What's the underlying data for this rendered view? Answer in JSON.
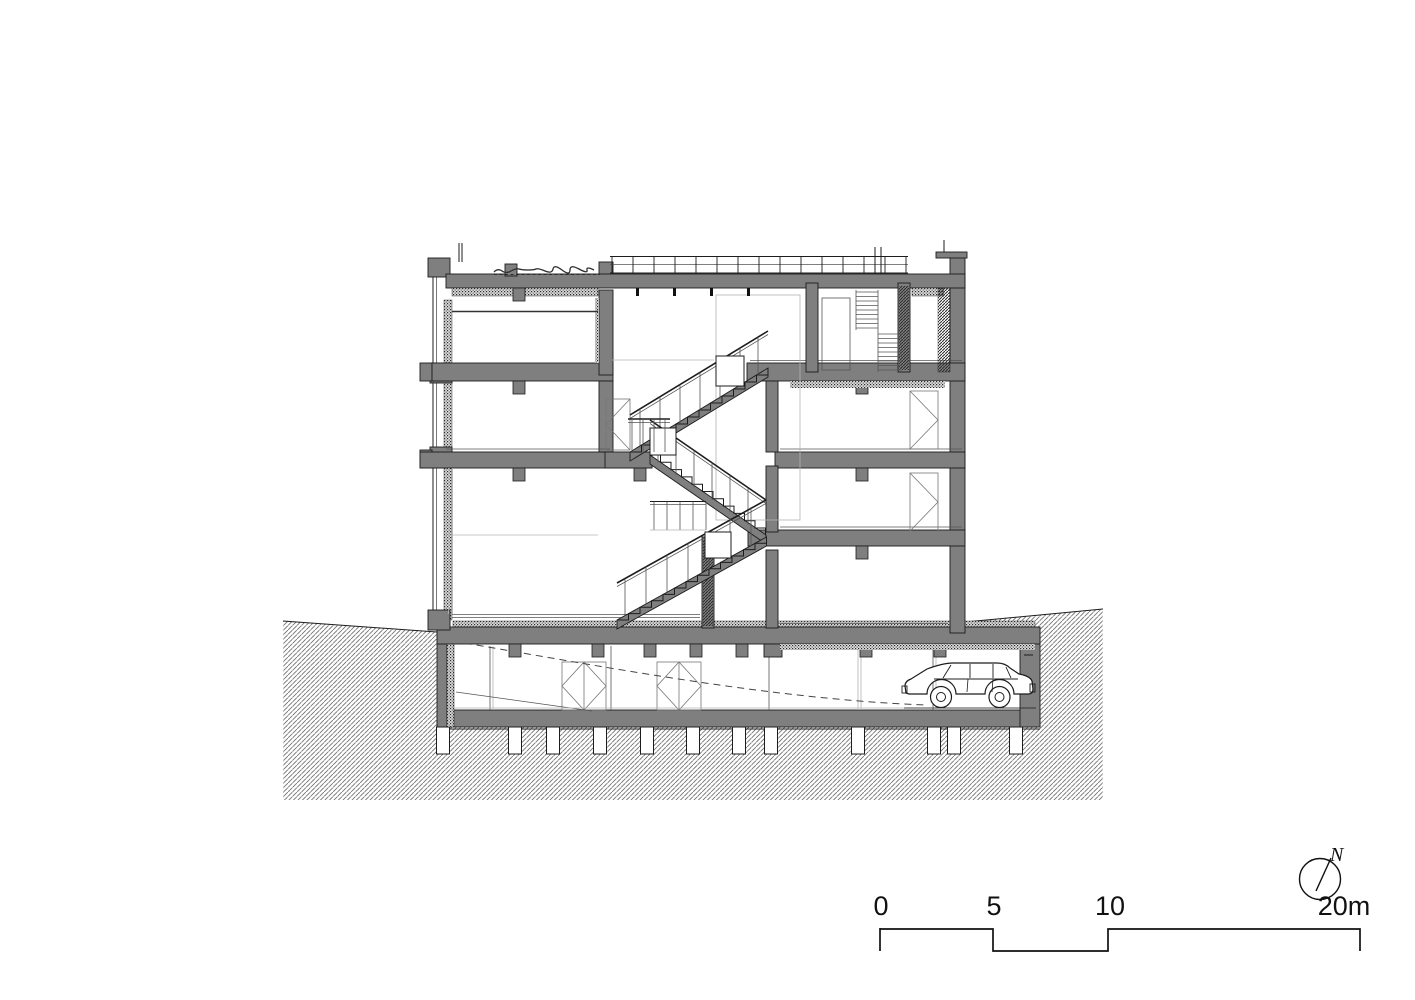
{
  "annotations": {
    "scale_bar": {
      "tick_labels": [
        "0",
        "5",
        "10",
        "20m"
      ],
      "unit": "m"
    },
    "north_arrow": {
      "label": "N"
    }
  },
  "colors": {
    "background": "#ffffff",
    "wall_poche": "#7f7f7f",
    "line_dark": "#1c1c1c",
    "earth_hatch": "#707070",
    "light_line": "#b4b4b4"
  },
  "icons": {
    "north": "north-arrow-icon",
    "scale": "scale-bar"
  }
}
